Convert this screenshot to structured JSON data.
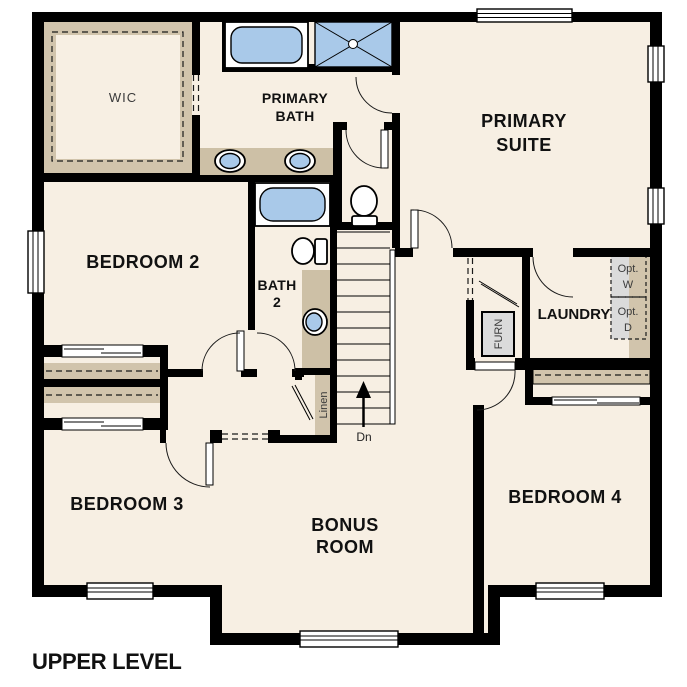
{
  "title": "UPPER LEVEL",
  "rooms": {
    "wic": "WIC",
    "primary_bath": {
      "line1": "PRIMARY",
      "line2": "BATH"
    },
    "primary_suite": {
      "line1": "PRIMARY",
      "line2": "SUITE"
    },
    "bedroom2": "BEDROOM 2",
    "bath2": {
      "line1": "BATH",
      "line2": "2"
    },
    "laundry": "LAUNDRY",
    "bedroom3": "BEDROOM 3",
    "bonus": {
      "line1": "BONUS",
      "line2": "ROOM"
    },
    "bedroom4": "BEDROOM 4"
  },
  "annotations": {
    "linen": "Linen",
    "furnace": "FURN",
    "stairs_down": "Dn",
    "opt_washer": {
      "line1": "Opt.",
      "line2": "W"
    },
    "opt_dryer": {
      "line1": "Opt.",
      "line2": "D"
    }
  },
  "colors": {
    "wall": "#000000",
    "floor": "#f7efe3",
    "casework_tan": "#d1c4ac",
    "fixture_blue": "#a9c9e9",
    "appliance_gray": "#dbdbdb"
  }
}
